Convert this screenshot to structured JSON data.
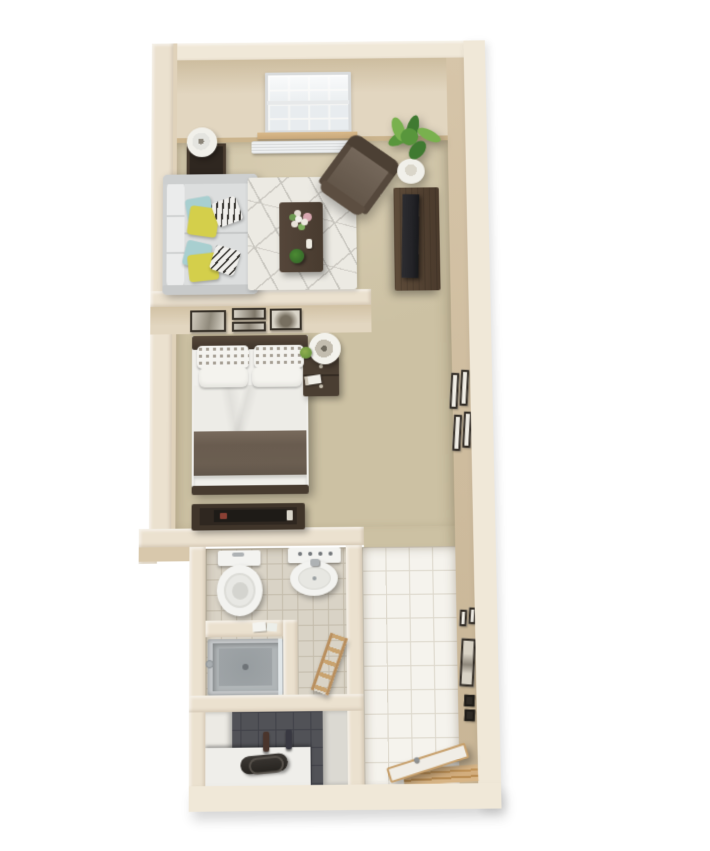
{
  "title": "3D Floor Plan - Studio Apartment",
  "scene": {
    "type": "3d-floor-plan",
    "view": "top-down isometric render on white background",
    "rooms": [
      {
        "id": "living-room",
        "items": [
          "window",
          "window-sill",
          "baseboard-heater",
          "side-table",
          "table-lamp",
          "sofa",
          "throw-pillows-yellow-teal-striped",
          "area-rug-geometric",
          "coffee-table",
          "flower-bouquet",
          "potted-plant-small",
          "candle",
          "armchair",
          "corner-floor-plant",
          "tv-console",
          "television"
        ]
      },
      {
        "id": "bedroom",
        "items": [
          "gallery-wall-frames",
          "double-bed",
          "patterned-pillows",
          "white-pillows",
          "duvet",
          "brown-blanket",
          "nightstand",
          "bedside-lamp",
          "book",
          "small-plant",
          "dresser",
          "flat-tv"
        ]
      },
      {
        "id": "hallway",
        "items": [
          "carpet",
          "wall-art-frames"
        ]
      },
      {
        "id": "bathroom",
        "items": [
          "toilet",
          "pedestal-sink",
          "partition-wall",
          "towels",
          "shower-stall",
          "shower-glass",
          "towel-ladder",
          "tile-floor"
        ]
      },
      {
        "id": "closet",
        "items": [
          "white-shelf-counter",
          "duffel-bag",
          "figurines",
          "dark-tiled-back"
        ]
      },
      {
        "id": "entry",
        "items": [
          "large-tile-floor",
          "open-door",
          "door-handle",
          "threshold-frame",
          "wall-switch-panels"
        ]
      }
    ]
  },
  "colors": {
    "canvasBg": "#ffffff",
    "wallTop": "#ebe1cf",
    "wallTopLight": "#f0e8d8",
    "wallFaceFar": "#e2d6c0",
    "wallFaceFarShadow": "#cdbd9f",
    "wallFaceRight": "#d6c5a9",
    "wallFaceRightDark": "#c8b596",
    "wallFaceOuter": "#d8c8ac",
    "carpet": "#ccc1a3",
    "carpetLight": "#d8cdb2",
    "rug": "#eceae3",
    "rugLine": "#c7c5be",
    "sofaBase": "#cfd1d1",
    "sofaCushion": "#dcdede",
    "sofaBack": "#ebecec",
    "pillowYellow": "#d4cf4b",
    "pillowTeal": "#a8cfd0",
    "pillowStripeBg": "#f0efec",
    "pillowStripeLine": "#2e2c28",
    "woodDark": "#483b2f",
    "woodDarker": "#2f2720",
    "chairBody": "#6a5c4e",
    "chairFrame": "#4c4034",
    "plantDark": "#3f7a31",
    "plantMid": "#58963c",
    "plantLight": "#79b14e",
    "potWhite": "#f1f0ea",
    "tvBlack": "#232327",
    "windowPane": "#e4e9ec",
    "windowFrame": "#f4f4f2",
    "sillWood": "#c9a87a",
    "baseboard": "#cbb48d",
    "heaterWhite": "#eef0f1",
    "bedWhite": "#f0efeb",
    "blanket": "#6b5e51",
    "tileBath": "#d9d3c6",
    "tileBathGrout": "#c4bcac",
    "tileEntry": "#f5f3ed",
    "tileEntryGrout": "#dcd7cb",
    "showerRim": "#c6c9cb",
    "showerPan": "#b0b5b7",
    "showerInner": "#9fa4a7",
    "closetDark": "#515257",
    "closetGrout": "#404148",
    "counterWhite": "#efeeea",
    "bagDark": "#26231f",
    "doorWhite": "#f0ede6",
    "frameDark": "#352f27",
    "frameMat": "#eeebe2",
    "fixtureWhite": "#f3f3f0",
    "fixtureShade": "#e4e4df",
    "chrome": "#aeb2b4"
  }
}
